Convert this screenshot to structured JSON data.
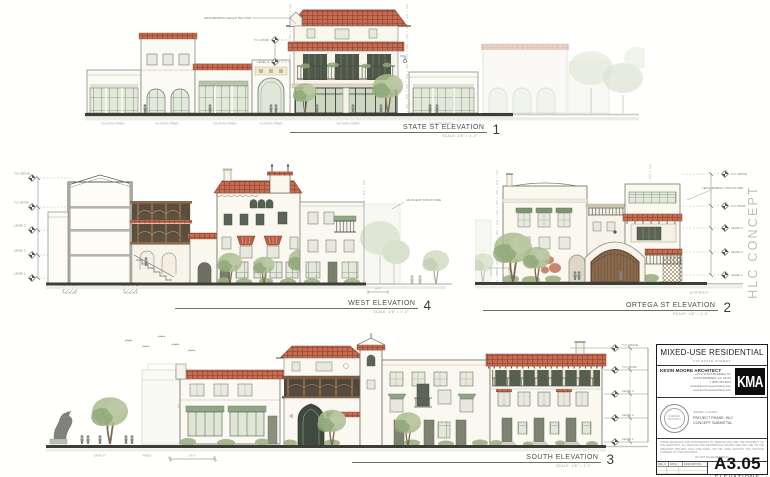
{
  "sheet": {
    "watermark": "HLC CONCEPT"
  },
  "drawings": {
    "state": {
      "name": "STATE ST ELEVATION",
      "number": "1",
      "scale": "SCALE: 1/8\" = 1'-0\"",
      "annotation": "NEIGHBORING HEIGHT BEYOND",
      "street_labels": [
        "700 STATE STREET",
        "704 STATE STREET",
        "706 STATE STREET",
        "710 STATE STREET",
        "714 STATE STREET",
        "718 STATE STREET"
      ],
      "datums": [
        "T.O. ROOF",
        "LEVEL 3"
      ]
    },
    "west": {
      "name": "WEST ELEVATION",
      "number": "4",
      "scale": "SCALE: 1/8\" = 1'-0\"",
      "datums": [
        "T.O. RIDGE",
        "T.O. ROOF",
        "LEVEL 3",
        "LEVEL 2",
        "LEVEL 1"
      ],
      "note": "ADJACENT STRUCTURE",
      "dim": "16'-0\""
    },
    "ortega": {
      "name": "ORTEGA ST ELEVATION",
      "number": "2",
      "scale": "SCALE: 1/8\" = 1'-0\"",
      "datums": [
        "T.O. RIDGE",
        "T.O. ROOF",
        "LEVEL 3",
        "LEVEL 2",
        "LEVEL 1"
      ],
      "note": "NEIGHBORING STRUCTURE",
      "street_note": "@ ORTEGA ST"
    },
    "south": {
      "name": "SOUTH ELEVATION",
      "number": "3",
      "scale": "SCALE: 1/8\" = 1'-0\"",
      "datums": [
        "T.O. RIDGE",
        "T.O. ROOF",
        "LEVEL 3",
        "LEVEL 2",
        "LEVEL 1"
      ],
      "street_labels": [
        "STATE ST",
        "PASEO"
      ],
      "dim": "24'-0\""
    }
  },
  "title_block": {
    "project_title": "MIXED-USE RESIDENTIAL",
    "project_address": "710 STATE STREET",
    "architect_name": "KEVIN MOORE ARCHITECT",
    "architect_lines": [
      "125 E SANTA BARBARA ST.",
      "SANTA BARBARA, CA. 93101",
      "T (805) 453-0074",
      "kevin@kevinmoorearchitect.com",
      "www.kevinmoorearchitect.com"
    ],
    "logo_text": "KMA",
    "issued": "ISSUED: 4.14.2021",
    "phase_line1": "PROJECT PHASE: HLC",
    "phase_line2": "CONCEPT SUBMITTAL",
    "stamp_line1": "LICENSED",
    "stamp_line2": "ARCHITECT",
    "disclaimer": "THESE DRAWINGS ARE INSTRUMENTS OF SERVICE AND ARE THE PROPERTY OF THE ARCHITECT. ALL DESIGNS AND INFORMATION SHOWN ARE FOR USE ON THE SPECIFIED PROJECT ONLY AND SHALL NOT BE USED WITHOUT THE WRITTEN CONSENT OF THE ARCHITECT.",
    "disclaimer_note": "DO NOT SCALE DRAWINGS",
    "rev_headers": [
      "REV. #",
      "DATE",
      "DESCRIPTION"
    ],
    "sheet_number": "A3.05",
    "sheet_title": "ELEVATIONS"
  }
}
